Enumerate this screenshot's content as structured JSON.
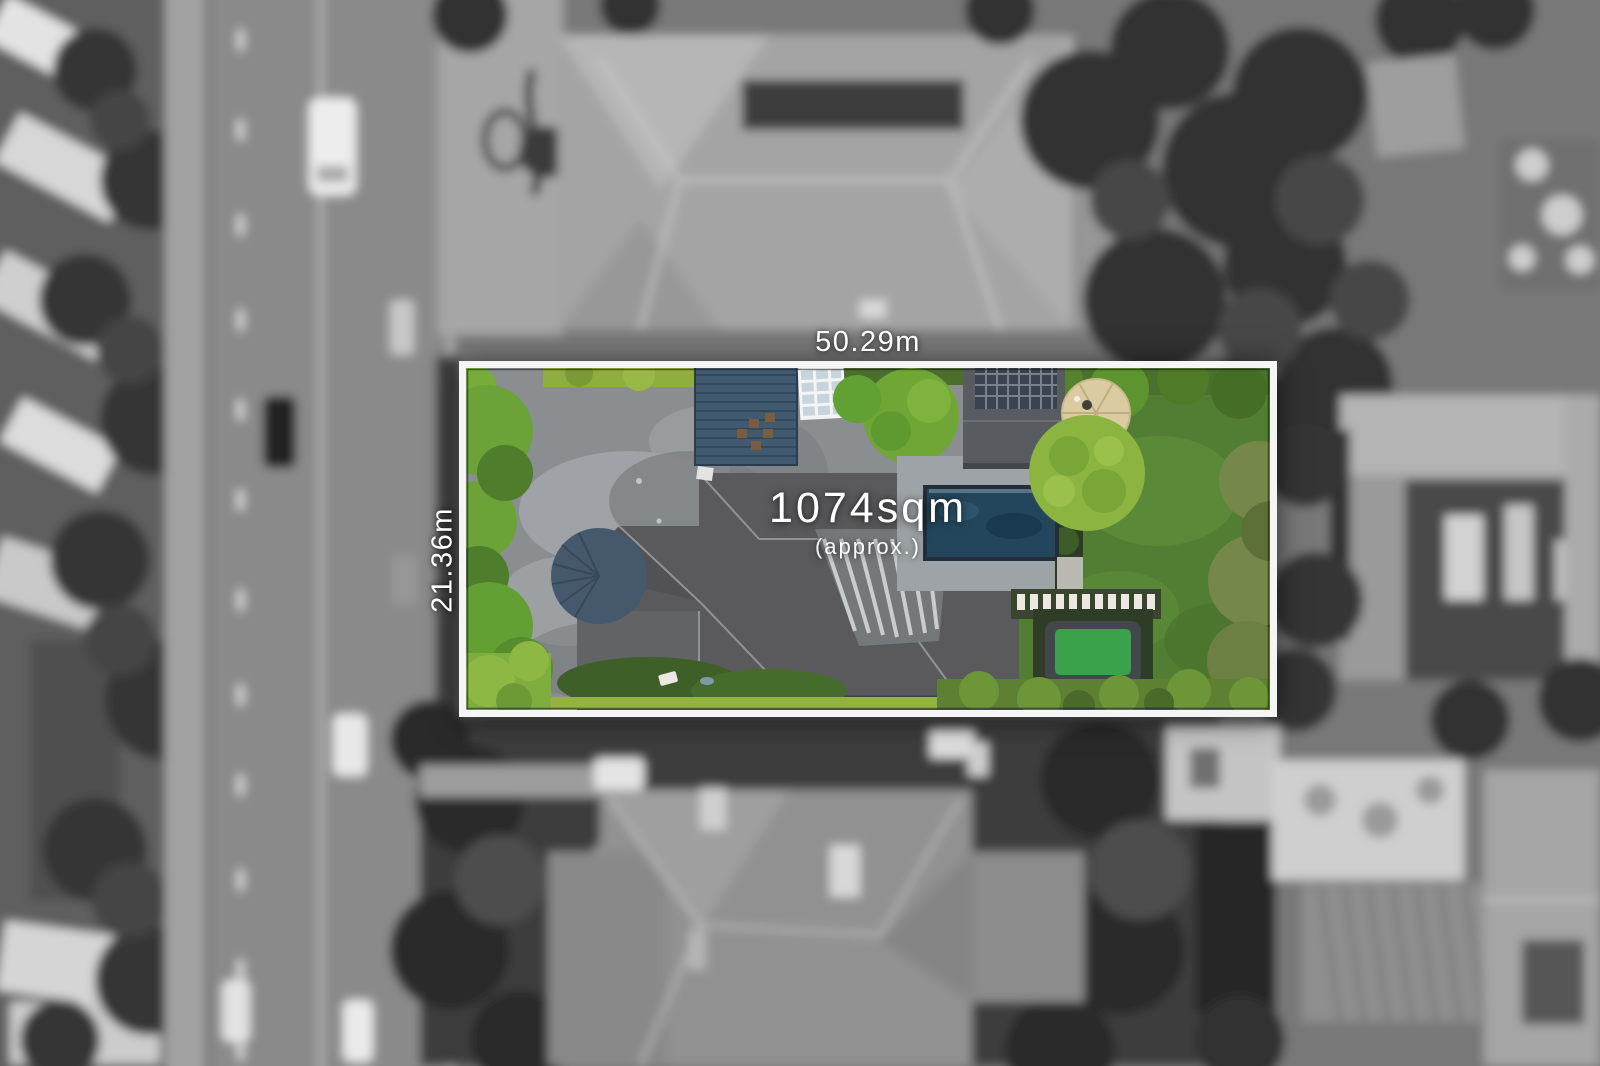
{
  "labels": {
    "frontage": "50.29m",
    "depth": "21.36m",
    "area": "1074sqm",
    "area_qualifier": "(approx.)"
  },
  "colors": {
    "boundary_line": "#f5f5f5",
    "label_text": "#ffffff",
    "pool_water": "#24465c",
    "lawn_green": "#527e33",
    "house_roof_gray": "#5a5a5c",
    "turret_roof": "#46586c",
    "garage_roof": "#415a70",
    "deck_tan": "#dbcba1",
    "trampoline_green": "#3aa24a",
    "hedge_bright_green": "#8fae3e"
  }
}
